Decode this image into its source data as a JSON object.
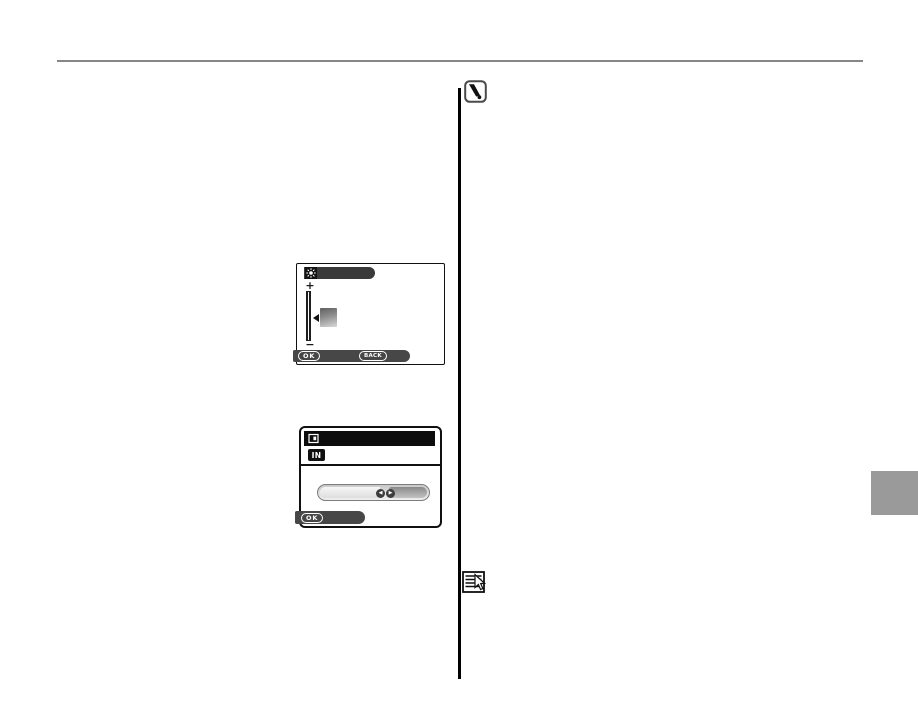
{
  "page": {
    "background": "#ffffff",
    "top_rule_color": "#878787",
    "divider_color": "#000000",
    "side_tab_color": "#9a9a9a"
  },
  "brightness_screen": {
    "title_icon": "sun-brightness-icon",
    "title_bar_color": "#3a3a3a",
    "plus_label": "+",
    "minus_label": "−",
    "ok_label": "OK",
    "back_label": "BACK",
    "button_bar_color": "#474747"
  },
  "format_screen": {
    "title_icon": "frame-icon",
    "title_bar_color": "#0d0d0d",
    "memory_badge_label": "IN",
    "arrow_left": "◀",
    "arrow_right": "▶",
    "ok_label": "OK",
    "button_bar_color": "#474747"
  },
  "margin_icons": {
    "caution_icon": "caution-exclamation-icon",
    "note_icon": "note-memo-icon"
  }
}
